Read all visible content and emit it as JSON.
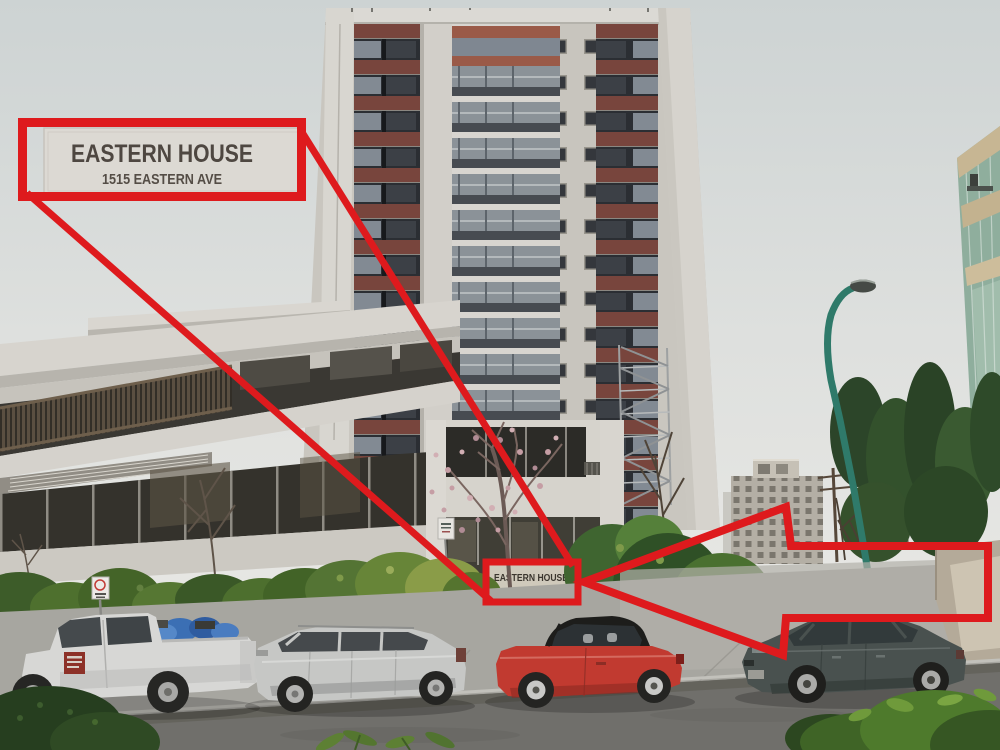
{
  "annotation": {
    "color": "#de1a1d",
    "callout_sign": {
      "title": "EASTERN HOUSE",
      "subtitle": "1515 EASTERN AVE"
    },
    "entrance_sign": {
      "title": "EASTERN HOUSE",
      "subtitle": "1515 EASTERN AVE"
    }
  },
  "scene": {
    "palette": {
      "sky": "#dee0de",
      "concrete_light": "#d7d4ce",
      "maroon_panel": "#78453d",
      "window_dark": "#2b2e33",
      "lamp_teal": "#2f7a6a",
      "hedge_green": "#4a6b2f",
      "road": "#706f6b",
      "sidewalk": "#a7a6a0",
      "truck_white": "#d7d7d5",
      "wagon_silver": "#c6c7c5",
      "convertible_red": "#c13a30",
      "sedan_gray": "#49514f"
    }
  }
}
